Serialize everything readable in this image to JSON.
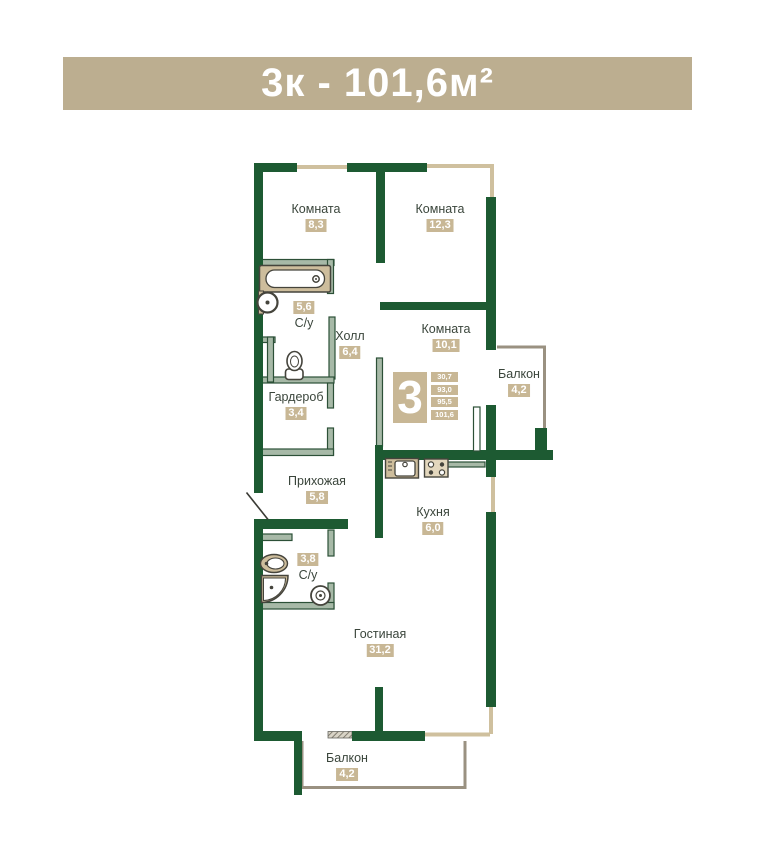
{
  "banner": {
    "title": "3к - 101,6м²"
  },
  "colors": {
    "banner_bg": "#bcae90",
    "wall_green": "#1d5a32",
    "thin_wall": "#a7b9a7",
    "window_tan": "#cfc09e",
    "badge_tan": "#c8b795",
    "label_text": "#3a453b",
    "fixture_tan": "#cdbd9c"
  },
  "rooms": [
    {
      "name": "Комната",
      "area": "8,3"
    },
    {
      "name": "Комната",
      "area": "12,3"
    },
    {
      "name": "С/у",
      "area": "5,6"
    },
    {
      "name": "Холл",
      "area": "6,4"
    },
    {
      "name": "Комната",
      "area": "10,1"
    },
    {
      "name": "Гардероб",
      "area": "3,4"
    },
    {
      "name": "Балкон",
      "area": "4,2"
    },
    {
      "name": "Прихожая",
      "area": "5,8"
    },
    {
      "name": "Кухня",
      "area": "6,0"
    },
    {
      "name": "С/у",
      "area": "3,8"
    },
    {
      "name": "Гостиная",
      "area": "31,2"
    },
    {
      "name": "Балкон",
      "area": "4,2"
    }
  ],
  "summary": {
    "rooms_count": "3",
    "values": [
      "30,7",
      "93,0",
      "95,5",
      "101,6"
    ]
  }
}
